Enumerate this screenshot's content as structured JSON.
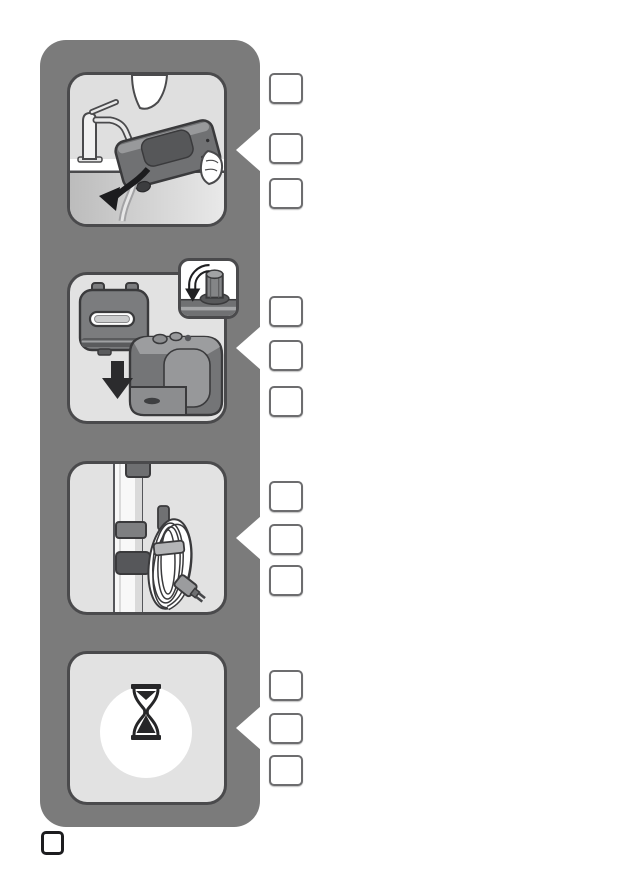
{
  "document": {
    "kind": "appliance-instruction-manual-page",
    "visible_text": "none",
    "description": "Vertical gray strip with four pictogram step panels; each step has three empty reference boxes to its right and a pointer notch; one empty page-number box at bottom left"
  },
  "steps": [
    {
      "index": 1,
      "pictogram": "empty-or-fill-water-tank-at-sink",
      "elements": [
        "faucet",
        "water-tank-held-by-hands",
        "water-stream",
        "curved-arrow-down-left"
      ],
      "reference_boxes": 3
    },
    {
      "index": 2,
      "pictogram": "place-water-tank-onto-base-unit",
      "elements": [
        "water-tank",
        "down-arrow",
        "base-unit",
        "cap-rotation-inset"
      ],
      "reference_boxes": 3
    },
    {
      "index": 3,
      "pictogram": "store-power-cord-on-pole-hook",
      "elements": [
        "pole-with-clips",
        "cord-hook",
        "coiled-cord",
        "plug"
      ],
      "reference_boxes": 3
    },
    {
      "index": 4,
      "pictogram": "wait",
      "elements": [
        "hourglass"
      ],
      "reference_boxes": 3
    }
  ],
  "footer": {
    "page_number_box_value": ""
  },
  "colors": {
    "page_bg": "#ffffff",
    "bar": "#7b7b7b",
    "panel_bg": "#e2e2e2",
    "panel_border": "#4a4a4c",
    "ink": "#3a3a3c",
    "device": "#747577",
    "device_dark": "#58595b",
    "device_light": "#9c9d9f",
    "box_border": "#6d6d6f",
    "footer_box_border": "#1d1d1f",
    "arrow": "#262628"
  }
}
